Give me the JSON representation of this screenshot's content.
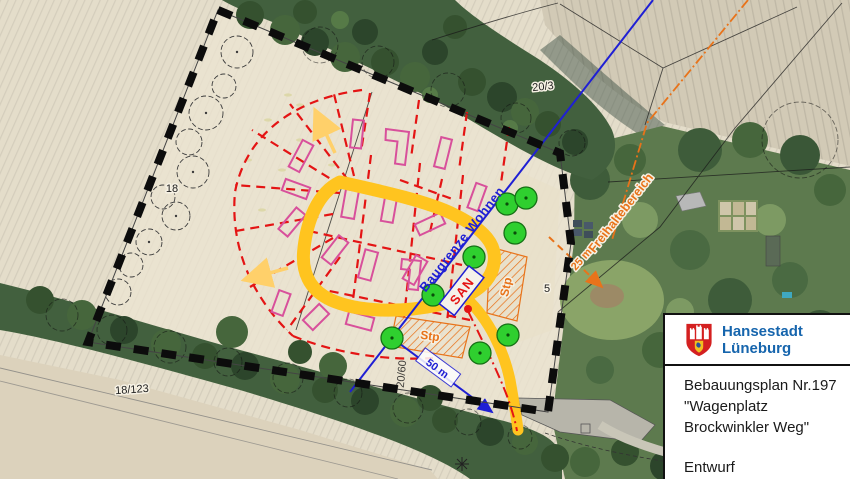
{
  "map": {
    "labels": {
      "parcel_20_3": "20/3",
      "parcel_18": "18",
      "parcel_18_123": "18/123",
      "parcel_20_60": "20/60",
      "parcel_5": "5",
      "baugrenze": "Baugrenze Wohnen",
      "san": "SAN",
      "stp_right": "Stp",
      "stp_bottom": "Stp",
      "freihaltebereich": "Freihaltebereich",
      "dist_25": "25 m",
      "dist_50": "50 m"
    },
    "colors": {
      "road": "#ffc41f",
      "tree_marker": "#2fcf2f",
      "plot_outline": "#d8509b",
      "boundary": "#0c0c0c",
      "restriction": "#e8731a",
      "baugrenze_line": "#1f1fd4",
      "parcel_line_red": "#e41414"
    }
  },
  "legend_box": {
    "city_name_line1": "Hansestadt",
    "city_name_line2": "Lüneburg",
    "plan_title_line1": "Bebauungsplan Nr.197",
    "plan_title_line2": "\"Wagenplatz",
    "plan_title_line3": "Brockwinkler Weg\"",
    "status": "Entwurf",
    "brand_color": "#1665ad"
  }
}
